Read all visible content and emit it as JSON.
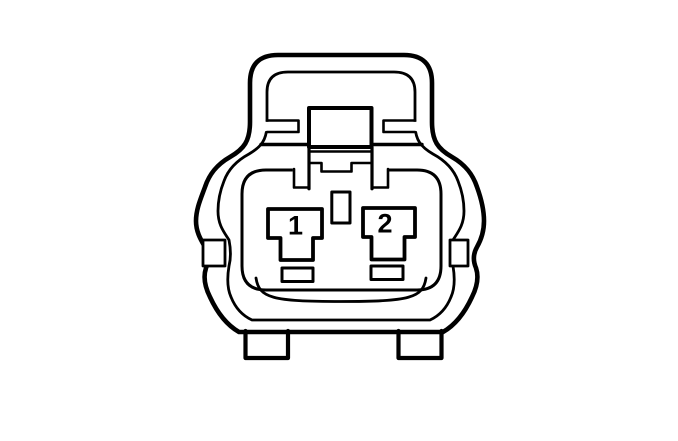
{
  "diagram": {
    "background_color": "#ffffff",
    "line_color": "#000000",
    "pins": [
      {
        "label": "1"
      },
      {
        "label": "2"
      }
    ]
  }
}
